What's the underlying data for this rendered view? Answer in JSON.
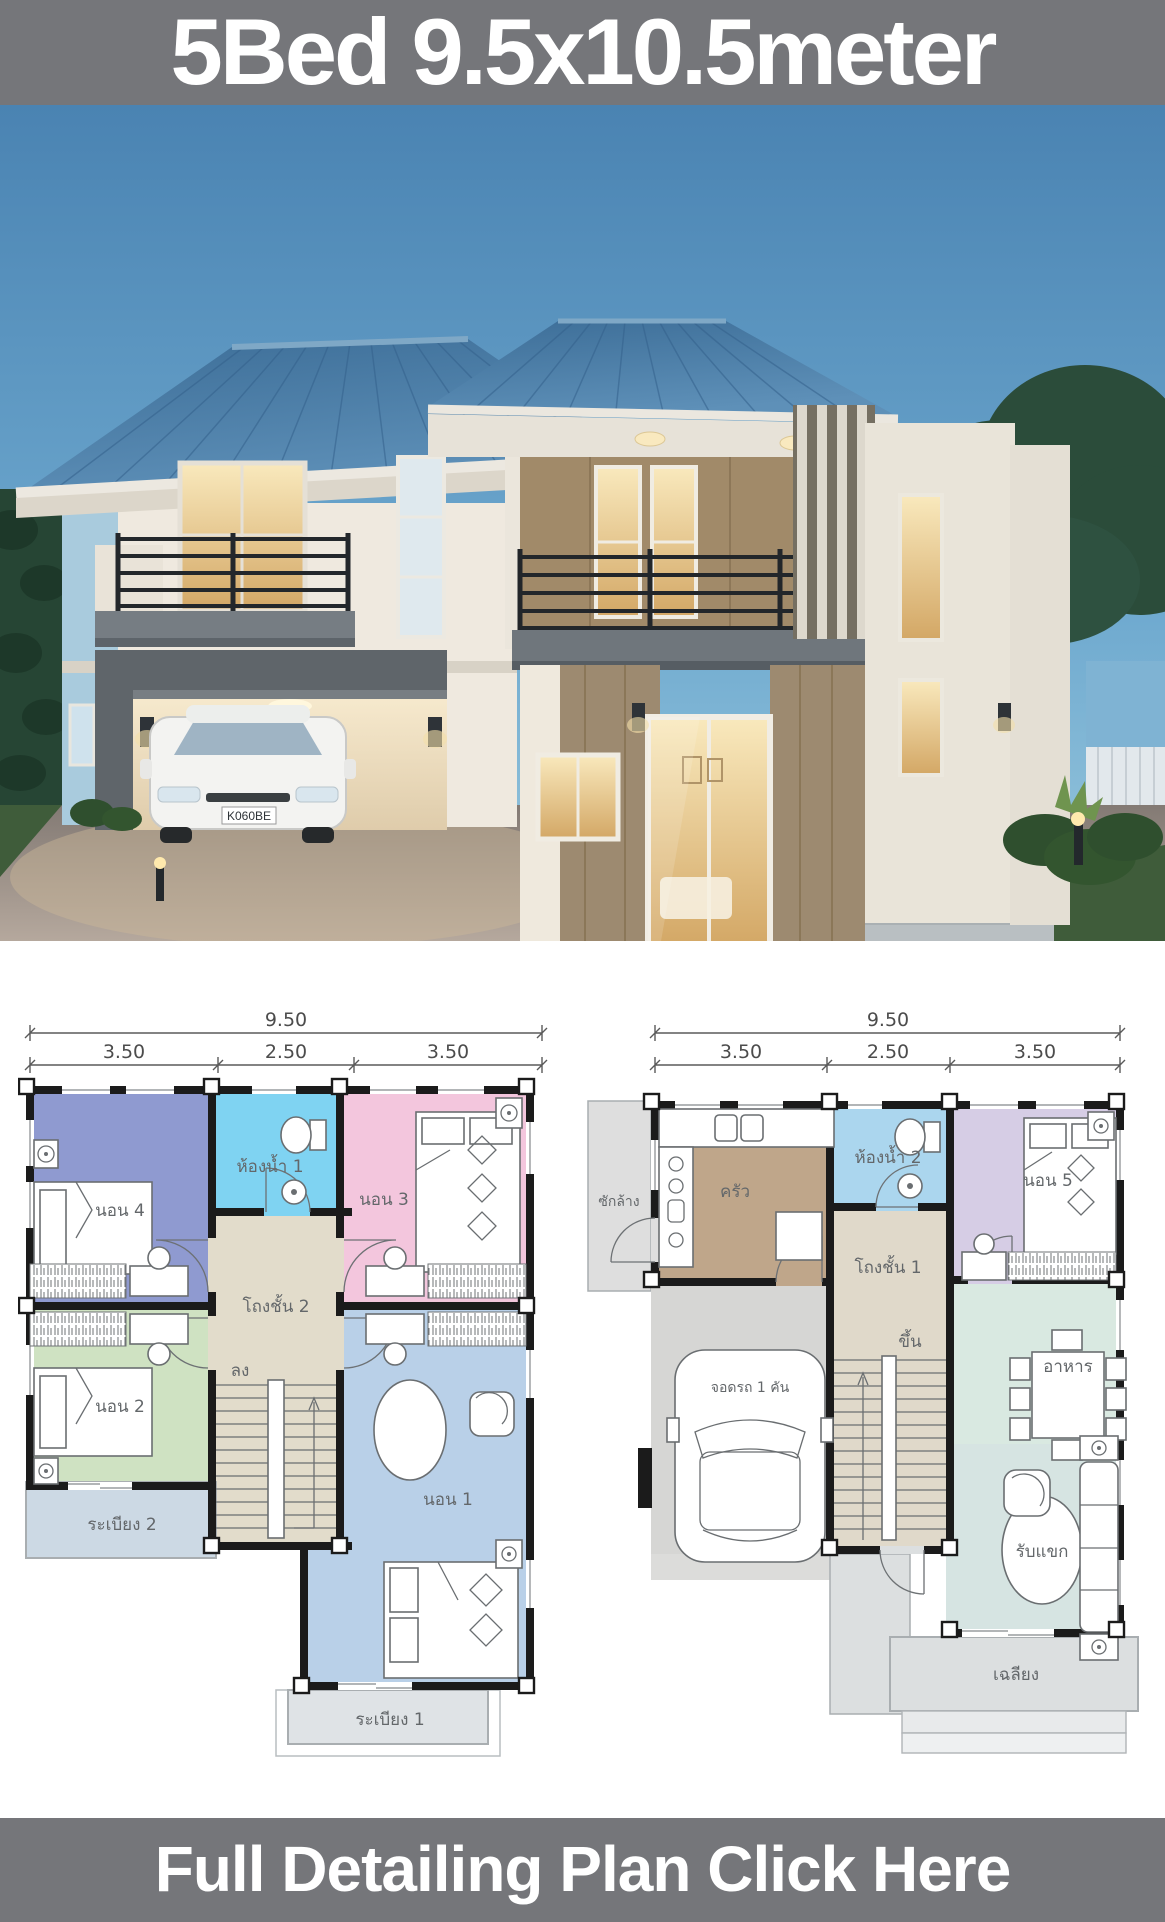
{
  "header": {
    "title": "5Bed 9.5x10.5meter"
  },
  "footer": {
    "cta": "Full Detailing Plan Click Here"
  },
  "photo": {
    "license_plate": "K060BE"
  },
  "floor2": {
    "dim_total": "9.50",
    "dim_segments": [
      "3.50",
      "2.50",
      "3.50"
    ],
    "rooms": {
      "bed4": "นอน 4",
      "bath1": "ห้องน้ำ 1",
      "bed3": "นอน 3",
      "hall": "โถงชั้น 2",
      "down": "ลง",
      "bed2": "นอน 2",
      "bed1": "นอน 1",
      "balcony2": "ระเบียง 2",
      "balcony1": "ระเบียง 1"
    }
  },
  "floor1": {
    "dim_total": "9.50",
    "dim_segments": [
      "3.50",
      "2.50",
      "3.50"
    ],
    "rooms": {
      "laundry": "ซักล้าง",
      "kitchen": "ครัว",
      "bath2": "ห้องน้ำ 2",
      "bed5": "นอน 5",
      "hall": "โถงชั้น 1",
      "up": "ขึ้น",
      "carpark": "จอดรถ 1 คัน",
      "dining": "อาหาร",
      "living": "รับแขก",
      "porch": "เฉลียง"
    }
  },
  "colors": {
    "banner_bg": "#75767a",
    "banner_text": "#ffffff",
    "sky_top": "#4a83b2",
    "sky_bottom": "#9ccade",
    "roof": "#44739c",
    "plan_wall": "#1b1b1b",
    "bed4": "#8f9ad0",
    "bath": "#7fd3f2",
    "bed3": "#f3c6dd",
    "hall2": "#e2dccb",
    "bed2": "#cfe2c2",
    "bed1": "#b9d0e8",
    "balcony2": "#ccd9e4",
    "balcony1": "#dfe3e6",
    "laundry": "#dedede",
    "kitchen": "#bfa68a",
    "bath2": "#abd6ee",
    "bed5": "#d6cde5",
    "hall1": "#e0d9ca",
    "garage": "#d6d6d4",
    "dining": "#d9e9e1",
    "living": "#d6e4e2",
    "porch": "#dcdfe0"
  }
}
